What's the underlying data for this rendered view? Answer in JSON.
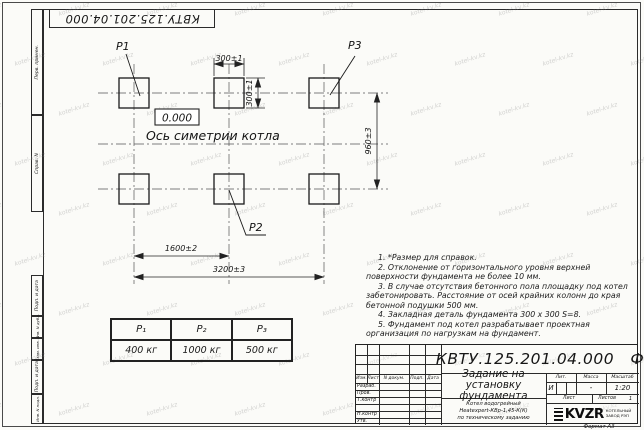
{
  "watermark": {
    "text": "kotel-kv.kz"
  },
  "stamp_top": {
    "code": "КВТУ.125.201.04.000"
  },
  "margin_labels": [
    "Перв. примен.",
    "Справ. N",
    "Подп. и дата",
    "Инв. N дубл.",
    "Взам. инв. N",
    "Подп. и дата",
    "Инв. N подл."
  ],
  "drawing": {
    "labels": {
      "p1": "Р1",
      "p2": "Р2",
      "p3": "Р3"
    },
    "elevation": "0.000",
    "axis_label": "Ось симетрии котла",
    "dims": {
      "d300h": "300±1",
      "d300v": "300±1",
      "d960": "960±3",
      "d1600": "1600±2",
      "d3200": "3200±3"
    }
  },
  "notes": [
    "1. *Размер для справок.",
    "2. Отклонение от горизонтального уровня верхней поверхности фундамента не более 10 мм.",
    "3. В случае отсутствия бетонного пола площадку под котел забетонировать. Расстояние от осей крайних колонн до края бетонной подушки 500 мм.",
    "4. Закладная деталь фундамента  300 x 300  S=8.",
    "5. Фундамент под котел разрабатывает проектная организация по нагрузкам на фундамент."
  ],
  "load_table": {
    "headers": [
      "Р₁",
      "Р₂",
      "Р₃"
    ],
    "values": [
      "400 кг",
      "1000 кг",
      "500 кг"
    ]
  },
  "title_block": {
    "doc_number": "КВТУ.125.201.04.000   Ф",
    "title": "Задание на установку фундамента",
    "subtitle_lines": [
      "Котел водогрейный",
      "Heatexpert-КВр-1,45-К(К)",
      "по техническому заданию"
    ],
    "header_cols": [
      "Изм.",
      "Лист",
      "N докум.",
      "Подп.",
      "Дата"
    ],
    "rows": [
      "Разраб.",
      "Пров.",
      "Т.контр",
      "",
      "Н.контр",
      "Утв."
    ],
    "lit_header": "Лит.",
    "mass_header": "Масса",
    "scale_header": "Масштаб",
    "lit": "И",
    "mass": "-",
    "scale": "1:20",
    "sheet_label": "Лист",
    "sheets_label": "Листов",
    "sheets_value": "1",
    "logo_text": "KVZR",
    "logo_caption_lines": [
      "КОТЕЛЬНЫЙ",
      "ЗАВОД РЭП"
    ],
    "format_label": "Формат А3"
  }
}
